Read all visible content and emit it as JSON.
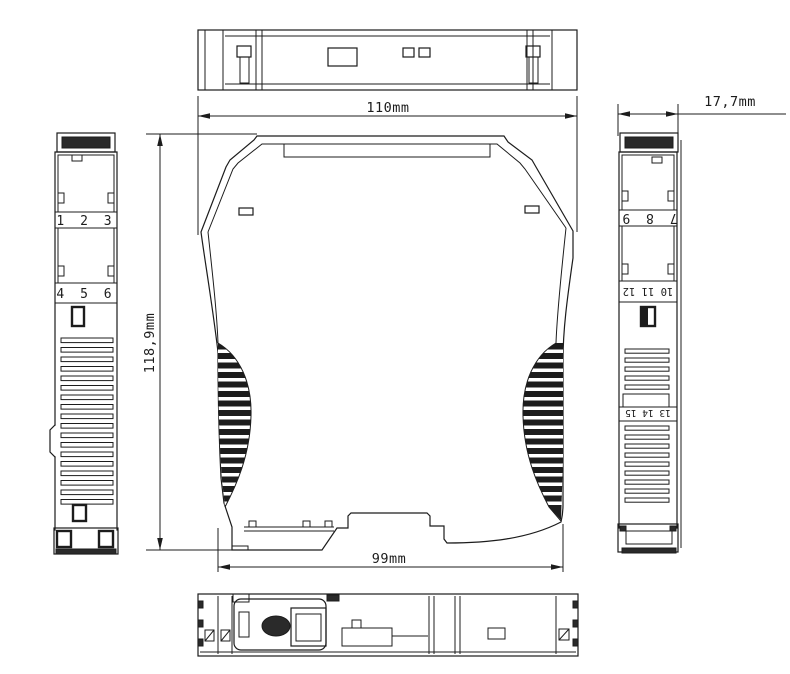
{
  "dimensions": {
    "top_width": "110mm",
    "side_width": "17,7mm",
    "height": "118,9mm",
    "bottom_width": "99mm"
  },
  "terminals": {
    "left_top": "1 2 3",
    "left_bottom": "4 5 6",
    "right_top": "7 8 9",
    "right_middle": "10 11 12",
    "right_bottom": "13 14 15"
  },
  "colors": {
    "line": "#1c1c1c",
    "background": "#ffffff"
  }
}
